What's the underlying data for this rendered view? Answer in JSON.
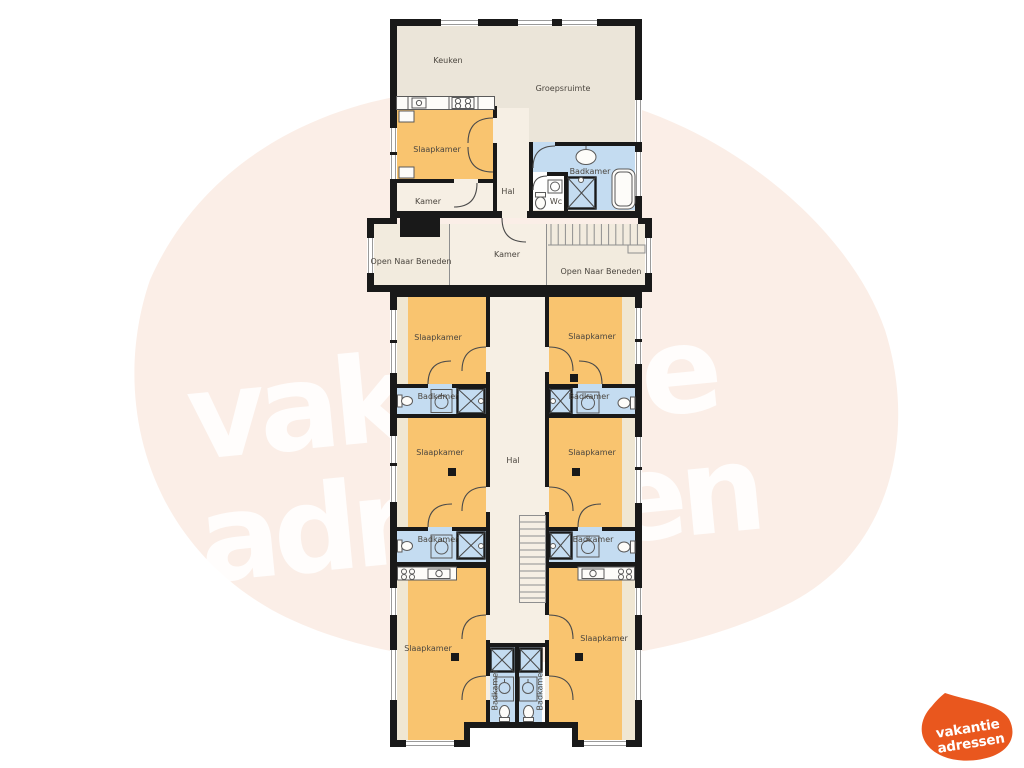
{
  "floorplan": {
    "labels": {
      "keuken": "Keuken",
      "groepsruimte": "Groepsruimte",
      "slaapkamer": "Slaapkamer",
      "badkamer": "Badkamer",
      "kamer": "Kamer",
      "hal": "Hal",
      "wc": "Wc",
      "open_naar_beneden": "Open Naar Beneden"
    },
    "colors": {
      "wall": "#191919",
      "bedroom": "#F9C46F",
      "bathroom": "#C4DCF1",
      "common_room": "#EBE5D9",
      "corridor": "#F6EFE4",
      "landing": "#F2EBDE",
      "accent_strip": "#F0E7D3",
      "background_blob": "#FBEEE7",
      "wc_room": "#FEFEFE"
    }
  },
  "watermark": {
    "line1": "vakantie",
    "line2": "adressen",
    "color": "rgba(255,255,255,0.85)"
  },
  "logo": {
    "line1": "vakantie",
    "line2": "adressen",
    "blob_color": "#E9571E",
    "text_color": "#FFFFFF"
  }
}
